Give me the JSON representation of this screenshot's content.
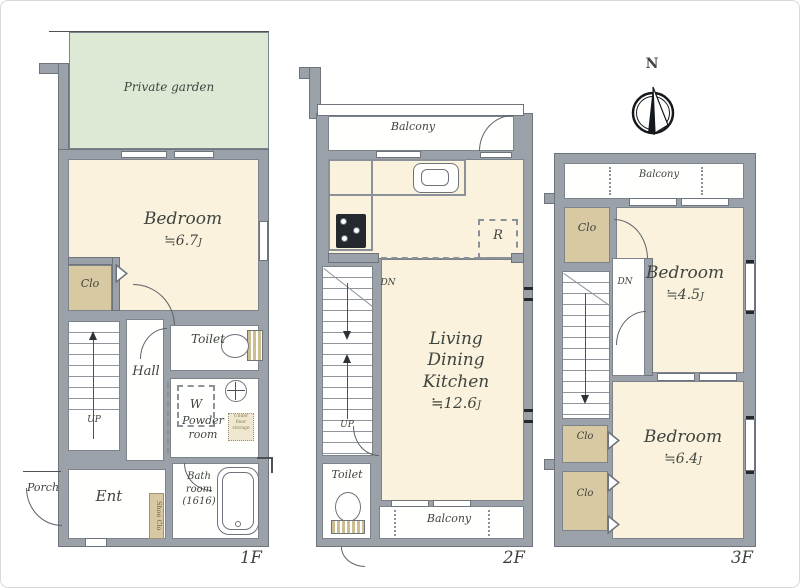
{
  "jou_unit": "J",
  "colors": {
    "wall": "#9aa1a8",
    "wall_edge": "#6d747b",
    "room_cream": "#faf2dc",
    "garden_green": "#dde9d4",
    "closet_tan": "#d8c9a2",
    "balcony_white": "#ffffff",
    "label_text": "#3e443f"
  },
  "compass": {
    "north_label": "N"
  },
  "f1": {
    "floor_label": "1F",
    "garden_label": "Private garden",
    "bedroom_label": "Bedroom",
    "bedroom_size": "≒6.7",
    "clo_label": "Clo",
    "toilet_label": "Toilet",
    "hall_label": "Hall",
    "washer_label": "W",
    "powder_label": "Powder room",
    "underfloor_label": "Under floor storage",
    "bath_label": "Bath room (1616)",
    "ent_label": "Ent",
    "shoe_label": "Shoe Clo",
    "porch_label": "Porch",
    "up_label": "UP"
  },
  "f2": {
    "floor_label": "2F",
    "balcony_top_label": "Balcony",
    "balcony_bottom_label": "Balcony",
    "fridge_label": "R",
    "dn_label": "DN",
    "up_label": "UP",
    "living_label": "Living",
    "dining_label": "Dining",
    "kitchen_label": "Kitchen",
    "ldk_size": "≒12.6",
    "toilet_label": "Toilet"
  },
  "f3": {
    "floor_label": "3F",
    "balcony_label": "Balcony",
    "clo_top_label": "Clo",
    "clo_mid_label": "Clo",
    "clo_bottom_label": "Clo",
    "dn_label": "DN",
    "bedroom1_label": "Bedroom",
    "bedroom1_size": "≒4.5",
    "bedroom2_label": "Bedroom",
    "bedroom2_size": "≒6.4"
  }
}
